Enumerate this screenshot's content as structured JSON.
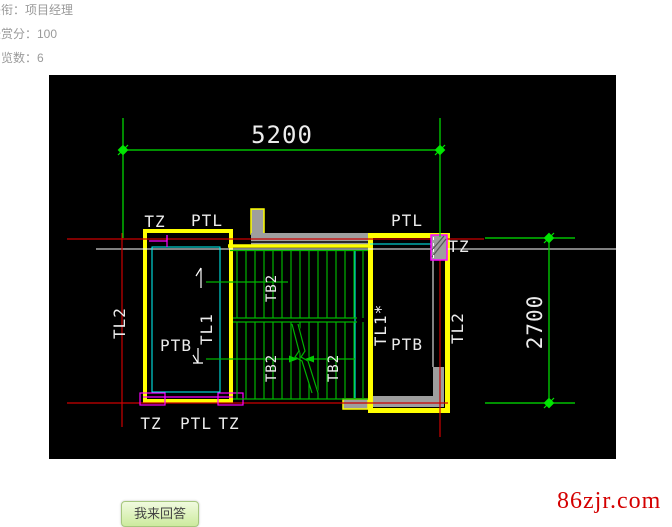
{
  "profile": {
    "line1": "头衔：项目经理",
    "line2": "悬赏分：100",
    "line3": "浏览数：6"
  },
  "actions": {
    "answer_button": "我来回答"
  },
  "watermark": {
    "text": "86zjr.com",
    "color": "#d40000"
  },
  "cad": {
    "dimensions": {
      "top": "5200",
      "right": "2700"
    },
    "labels": {
      "tz_top_left": "TZ",
      "ptl_top_left": "PTL",
      "ptl_top_right": "PTL",
      "tz_right": "TZ",
      "tl2_left": "TL2",
      "tl1_left": "TL1",
      "ptb_left": "PTB",
      "tb2_upper": "TB2",
      "tb2_lower_left": "TB2",
      "tb2_lower_right": "TB2",
      "tl1_star_right": "TL1*",
      "ptb_right": "PTB",
      "tl2_right": "TL2",
      "tz_bottom_left": "TZ",
      "ptl_bottom": "PTL",
      "tz_bottom_mid": "TZ"
    },
    "colors": {
      "background": "#000000",
      "beam_outline": "#ffff00",
      "grid_line": "#cc0000",
      "dimension": "#00e600",
      "tread": "#00b400",
      "detail_cyan": "#00ffff",
      "detail_magenta": "#ff00ff",
      "slab_gray": "#9e9e9e",
      "text": "#ececec"
    }
  }
}
